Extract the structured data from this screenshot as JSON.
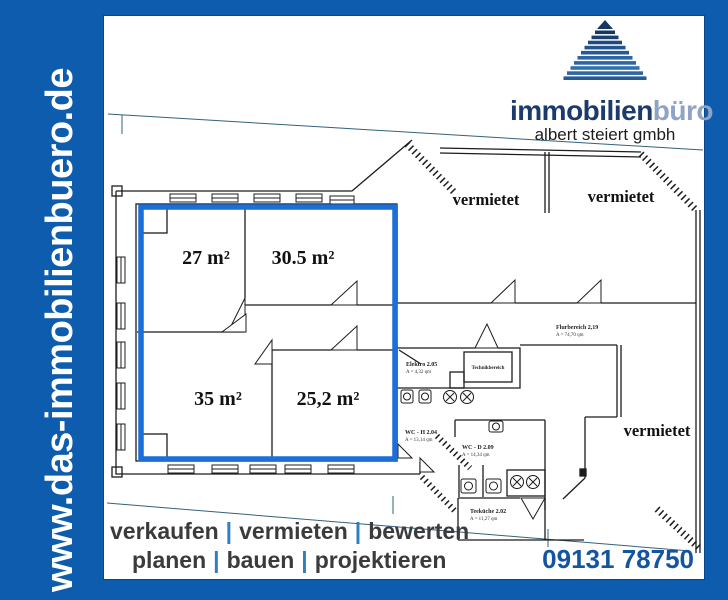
{
  "banner": {
    "url": "www.das-immobilienbuero.de",
    "bg_color": "#0e5cad"
  },
  "logo": {
    "name_dark": "immobilien",
    "name_light": "büro",
    "subtitle": "albert steiert gmbh",
    "navy": "#1b3a6d",
    "light_blue": "#8fa3c5"
  },
  "plan": {
    "highlight_color": "#1c6fd6",
    "rooms": [
      {
        "label": "27 m²"
      },
      {
        "label": "30.5 m²"
      },
      {
        "label": "35 m²"
      },
      {
        "label": "25,2 m²"
      }
    ],
    "rented_label": "vermietet",
    "small_rooms": {
      "elektro": {
        "name": "Elektro 2.05",
        "area": "A = 4,32 qm"
      },
      "technik": {
        "name": "Technikbereich"
      },
      "flur": {
        "name": "Flurbereich 2,19",
        "area": "A = 74,70 qm"
      },
      "wc_h": {
        "name": "WC - H 2.04",
        "area": "A = 13,14 qm"
      },
      "wc_d": {
        "name": "WC - D 2.09",
        "area": "A = 14,34 qm"
      },
      "teekueche": {
        "name": "Teeküche 2.02",
        "area": "A = 11,27 qm"
      }
    }
  },
  "footer": {
    "line1_words": [
      "verkaufen",
      "vermieten",
      "bewerten"
    ],
    "line2_words": [
      "planen",
      "bauen",
      "projektieren"
    ],
    "separator": "|",
    "phone": "09131 78750"
  }
}
